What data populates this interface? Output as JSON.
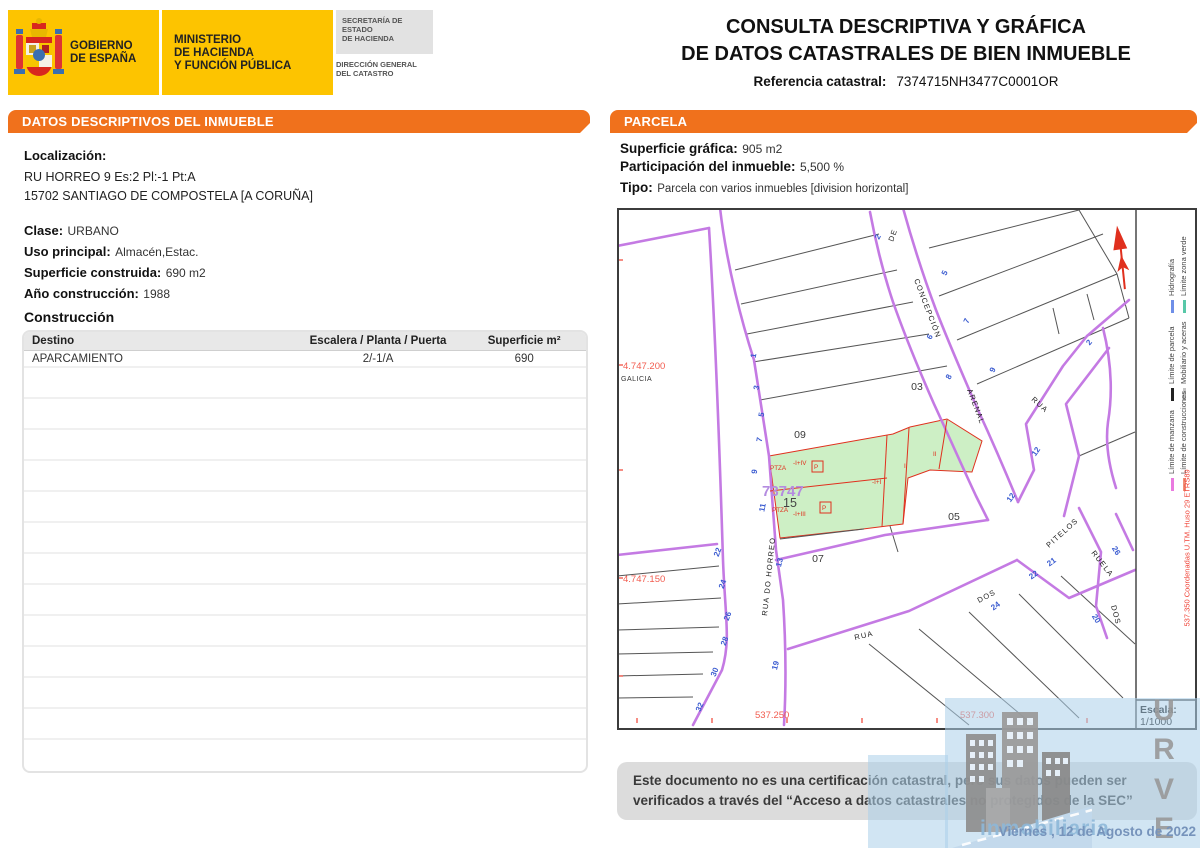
{
  "header": {
    "gobierno": "GOBIERNO\nDE ESPAÑA",
    "ministerio": "MINISTERIO\nDE HACIENDA\nY FUNCIÓN PÚBLICA",
    "secretaria": "SECRETARÍA DE ESTADO\nDE HACIENDA",
    "direccion": "DIRECCIÓN GENERAL\nDEL CATASTRO",
    "title_line1": "CONSULTA DESCRIPTIVA Y GRÁFICA",
    "title_line2": "DE DATOS CATASTRALES DE BIEN INMUEBLE",
    "ref_label": "Referencia catastral:",
    "ref_value": "7374715NH3477C0001OR"
  },
  "left_panel": {
    "section_title": "DATOS DESCRIPTIVOS DEL INMUEBLE",
    "localizacion_label": "Localización:",
    "address_line1": "RU HORREO 9 Es:2 Pl:-1 Pt:A",
    "address_line2": "15702 SANTIAGO DE COMPOSTELA [A CORUÑA]",
    "clase_label": "Clase:",
    "clase_value": "URBANO",
    "uso_label": "Uso principal:",
    "uso_value": "Almacén,Estac.",
    "superficie_label": "Superficie construida:",
    "superficie_value": "690 m2",
    "anio_label": "Año construcción:",
    "anio_value": "1988",
    "construccion_title": "Construcción",
    "table": {
      "headers": [
        "Destino",
        "Escalera / Planta / Puerta",
        "Superficie m²"
      ],
      "rows": [
        [
          "APARCAMIENTO",
          "2/-1/A",
          "690"
        ]
      ],
      "empty_row_count": 13
    }
  },
  "right_panel": {
    "section_title": "PARCELA",
    "superficie_grafica_label": "Superficie gráfica:",
    "superficie_grafica_value": "905 m2",
    "participacion_label": "Participación del inmueble:",
    "participacion_value": "5,500 %",
    "tipo_label": "Tipo:",
    "tipo_value": "Parcela con varios inmuebles [division horizontal]",
    "disclaimer": "Este documento no es una certificación catastral, pero sus datos pueden ser verificados a través del “Acceso a datos catastrales no protegidos de la SEC”",
    "date": "Viernes , 12 de Agosto de 2022"
  },
  "map": {
    "coordinate_labels": [
      {
        "text": "4.747.200",
        "x": 6,
        "y": 161
      },
      {
        "text": "4.747.150",
        "x": 6,
        "y": 374
      },
      {
        "text": "537.250",
        "x": 138,
        "y": 510
      },
      {
        "text": "537.300",
        "x": 343,
        "y": 510
      }
    ],
    "region_labels": [
      {
        "text": "GALICIA",
        "x": 4,
        "y": 173
      }
    ],
    "parcel_labels": [
      {
        "text": "09",
        "x": 183,
        "y": 230
      },
      {
        "text": "03",
        "x": 300,
        "y": 182
      },
      {
        "text": "05",
        "x": 337,
        "y": 312
      },
      {
        "text": "07",
        "x": 201,
        "y": 354
      }
    ],
    "parcel15_label": "15",
    "manzana_label": "73747",
    "street_labels": [
      {
        "text": "DE",
        "x": 276,
        "y": 34,
        "rot": -70
      },
      {
        "text": "CONCEPCIÓN",
        "x": 297,
        "y": 72,
        "rot": 69
      },
      {
        "text": "ARENAL",
        "x": 350,
        "y": 182,
        "rot": 69
      },
      {
        "text": "RUA",
        "x": 414,
        "y": 192,
        "rot": 42
      },
      {
        "text": "RUA DO HORREO",
        "x": 150,
        "y": 408,
        "rot": -84
      },
      {
        "text": "RUA",
        "x": 238,
        "y": 432,
        "rot": -13
      },
      {
        "text": "DOS",
        "x": 362,
        "y": 395,
        "rot": -28
      },
      {
        "text": "PITELOS",
        "x": 432,
        "y": 340,
        "rot": -42
      },
      {
        "text": "RUELA",
        "x": 474,
        "y": 345,
        "rot": 52
      },
      {
        "text": "DOS",
        "x": 494,
        "y": 398,
        "rot": 75
      }
    ],
    "house_numbers": [
      {
        "text": "2",
        "x": 263,
        "y": 30,
        "rot": -62
      },
      {
        "text": "5",
        "x": 330,
        "y": 66,
        "rot": -64
      },
      {
        "text": "7",
        "x": 352,
        "y": 114,
        "rot": -64
      },
      {
        "text": "9",
        "x": 378,
        "y": 163,
        "rot": -64
      },
      {
        "text": "6",
        "x": 315,
        "y": 130,
        "rot": -62
      },
      {
        "text": "8",
        "x": 334,
        "y": 170,
        "rot": -62
      },
      {
        "text": "2",
        "x": 474,
        "y": 136,
        "rot": -50
      },
      {
        "text": "1",
        "x": 139,
        "y": 148,
        "rot": -80
      },
      {
        "text": "3",
        "x": 142,
        "y": 180,
        "rot": -80
      },
      {
        "text": "5",
        "x": 147,
        "y": 207,
        "rot": -80
      },
      {
        "text": "7",
        "x": 145,
        "y": 232,
        "rot": -80
      },
      {
        "text": "9",
        "x": 140,
        "y": 264,
        "rot": -80
      },
      {
        "text": "11",
        "x": 148,
        "y": 300,
        "rot": -80
      },
      {
        "text": "13",
        "x": 165,
        "y": 355,
        "rot": -76
      },
      {
        "text": "19",
        "x": 161,
        "y": 458,
        "rot": -76
      },
      {
        "text": "22",
        "x": 103,
        "y": 345,
        "rot": -70
      },
      {
        "text": "24",
        "x": 108,
        "y": 377,
        "rot": -70
      },
      {
        "text": "26",
        "x": 113,
        "y": 409,
        "rot": -70
      },
      {
        "text": "28",
        "x": 110,
        "y": 434,
        "rot": -70
      },
      {
        "text": "30",
        "x": 100,
        "y": 465,
        "rot": -68
      },
      {
        "text": "32",
        "x": 85,
        "y": 500,
        "rot": -66
      },
      {
        "text": "12",
        "x": 421,
        "y": 245,
        "rot": -55
      },
      {
        "text": "12",
        "x": 396,
        "y": 291,
        "rot": -55
      },
      {
        "text": "21",
        "x": 436,
        "y": 356,
        "rot": -36
      },
      {
        "text": "22",
        "x": 418,
        "y": 369,
        "rot": -36
      },
      {
        "text": "24",
        "x": 380,
        "y": 400,
        "rot": -36
      },
      {
        "text": "20",
        "x": 477,
        "y": 412,
        "rot": 58
      },
      {
        "text": "26",
        "x": 497,
        "y": 344,
        "rot": 58
      }
    ],
    "construction_labels": [
      {
        "text": "PTZA",
        "x": 153,
        "y": 262
      },
      {
        "text": "-I+IV",
        "x": 176,
        "y": 257
      },
      {
        "text": "P",
        "x": 197,
        "y": 261
      },
      {
        "text": "PTZA",
        "x": 155,
        "y": 304
      },
      {
        "text": "-I+III",
        "x": 176,
        "y": 308
      },
      {
        "text": "P",
        "x": 205,
        "y": 302
      },
      {
        "text": "-I+I",
        "x": 255,
        "y": 276
      },
      {
        "text": "I",
        "x": 287,
        "y": 260
      },
      {
        "text": "II",
        "x": 316,
        "y": 248
      }
    ],
    "legend": {
      "items": [
        {
          "label": "Límite de manzana",
          "color": "#EA7AE0"
        },
        {
          "label": "Límite de construcciones",
          "color": "#F09078"
        },
        {
          "label": "Límite de parcela",
          "color": "#222222"
        },
        {
          "label": "Mobiliario y aceras",
          "color": "#C4C4C4"
        },
        {
          "label": "Hidrografía",
          "color": "#6F8FE8"
        },
        {
          "label": "Límite zona verde",
          "color": "#58C8A8"
        }
      ],
      "crs_note": "537.350 Coordenadas U.TM. Huso 29 ETRS89",
      "scale_label": "Escala:",
      "scale_value": "1/1000"
    }
  },
  "watermark": {
    "letters": [
      "U",
      "R",
      "V",
      "E"
    ],
    "subtitle": "inmobiliaria"
  },
  "colors": {
    "accent_orange": "#F0711C",
    "gov_yellow": "#FDC400",
    "street_purple": "#C47AE3",
    "parcel_green": "#CDEFC5",
    "construction_red": "#E0301E",
    "house_number_blue": "#3A5BD0",
    "coordinate_red": "#F25C4F",
    "date_blue": "#7693BB"
  }
}
